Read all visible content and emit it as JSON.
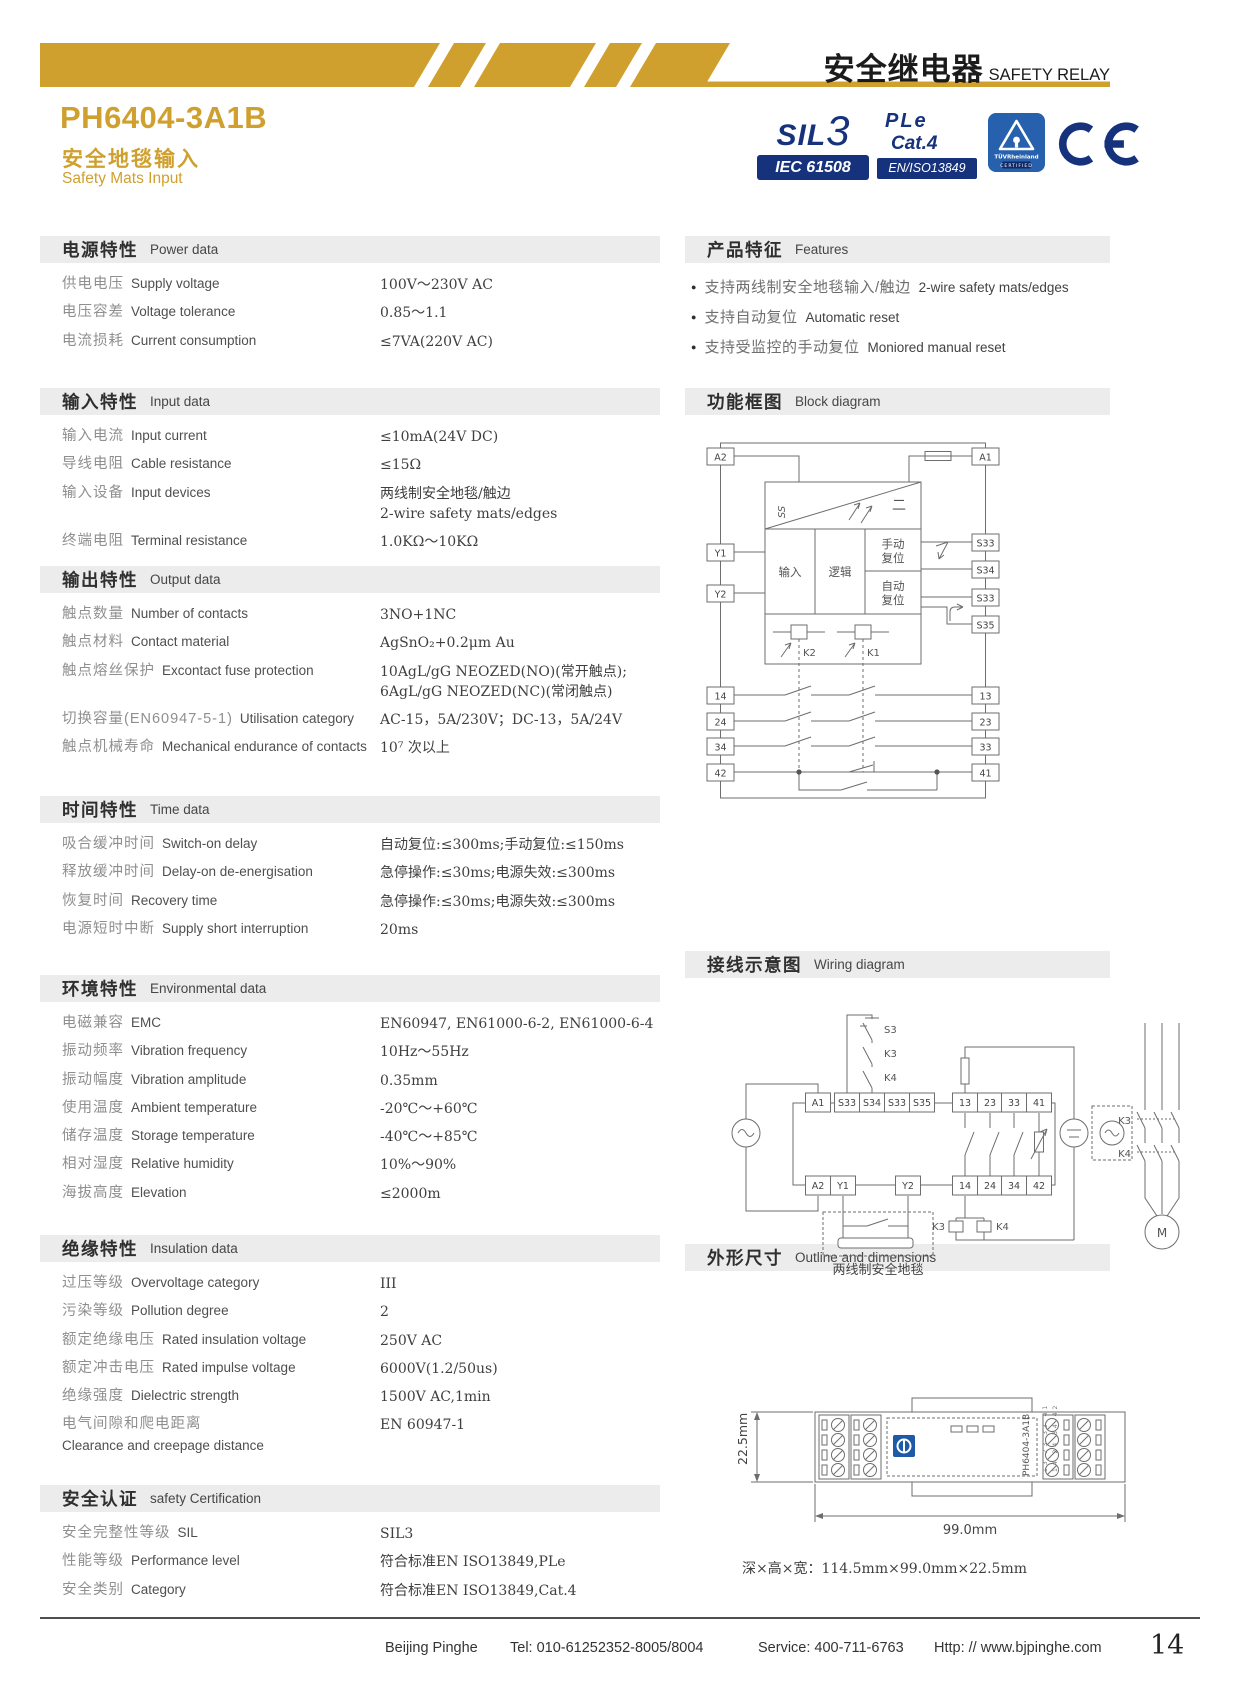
{
  "colors": {
    "accent_gold": "#D0A02E",
    "badge_navy": "#16327C",
    "tuv_blue": "#2760AC"
  },
  "header": {
    "brand_cn": "安全继电器",
    "brand_en": "SAFETY RELAY",
    "model": "PH6404-3A1B",
    "subtitle_cn": "安全地毯输入",
    "subtitle_en": "Safety Mats Input"
  },
  "badges": {
    "sil_text": "SIL",
    "sil_level": "3",
    "sil_standard": "IEC 61508",
    "pl_line1": "PLe",
    "pl_line2": "Cat.4",
    "pl_standard": "EN/ISO13849",
    "tuv_name": "TÜVRheinland",
    "tuv_sub": "CERTIFIED",
    "ce_mark": "CE"
  },
  "spec_sections": [
    {
      "id": "power",
      "title_cn": "电源特性",
      "title_en": "Power data",
      "rows": [
        {
          "cn": "供电电压",
          "en": "Supply voltage",
          "value": [
            "100V～230V AC"
          ]
        },
        {
          "cn": "电压容差",
          "en": "Voltage tolerance",
          "value": [
            "0.85～1.1"
          ]
        },
        {
          "cn": "电流损耗",
          "en": "Current consumption",
          "value": [
            "≤7VA(220V AC)"
          ]
        }
      ]
    },
    {
      "id": "input",
      "title_cn": "输入特性",
      "title_en": "Input data",
      "rows": [
        {
          "cn": "输入电流",
          "en": "Input current",
          "value": [
            "≤10mA(24V DC)"
          ]
        },
        {
          "cn": "导线电阻",
          "en": "Cable resistance",
          "value": [
            "≤15Ω"
          ]
        },
        {
          "cn": "输入设备",
          "en": "Input devices",
          "value": [
            "两线制安全地毯/触边",
            "2-wire safety mats/edges"
          ]
        },
        {
          "cn": "终端电阻",
          "en": "Terminal resistance",
          "value": [
            "1.0KΩ～10KΩ"
          ]
        }
      ]
    },
    {
      "id": "output",
      "title_cn": "输出特性",
      "title_en": "Output data",
      "rows": [
        {
          "cn": "触点数量",
          "en": "Number of contacts",
          "value": [
            "3NO+1NC"
          ]
        },
        {
          "cn": "触点材料",
          "en": "Contact material",
          "value": [
            "AgSnO₂+0.2μm Au"
          ]
        },
        {
          "cn": "触点熔丝保护",
          "en": "Excontact fuse protection",
          "value": [
            "10AgL/gG NEOZED(NO)(常开触点);",
            "6AgL/gG NEOZED(NC)(常闭触点)"
          ]
        },
        {
          "cn": "切换容量(EN60947-5-1)",
          "en": "Utilisation category",
          "value": [
            "AC-15，5A/230V；DC-13，5A/24V"
          ]
        },
        {
          "cn": "触点机械寿命",
          "en": "Mechanical endurance of contacts",
          "value": [
            "10⁷ 次以上"
          ]
        }
      ]
    },
    {
      "id": "time",
      "title_cn": "时间特性",
      "title_en": "Time data",
      "rows": [
        {
          "cn": "吸合缓冲时间",
          "en": "Switch-on delay",
          "value": [
            "自动复位:≤300ms;手动复位:≤150ms"
          ]
        },
        {
          "cn": "释放缓冲时间",
          "en": "Delay-on de-energisation",
          "value": [
            "急停操作:≤30ms;电源失效:≤300ms"
          ]
        },
        {
          "cn": "恢复时间",
          "en": "Recovery time",
          "value": [
            "急停操作:≤30ms;电源失效:≤300ms"
          ]
        },
        {
          "cn": "电源短时中断",
          "en": "Supply short interruption",
          "value": [
            "20ms"
          ]
        }
      ]
    },
    {
      "id": "environment",
      "title_cn": "环境特性",
      "title_en": "Environmental data",
      "rows": [
        {
          "cn": "电磁兼容",
          "en": "EMC",
          "value": [
            "EN60947, EN61000-6-2, EN61000-6-4"
          ]
        },
        {
          "cn": "振动频率",
          "en": "Vibration frequency",
          "value": [
            "10Hz～55Hz"
          ]
        },
        {
          "cn": "振动幅度",
          "en": "Vibration amplitude",
          "value": [
            "0.35mm"
          ]
        },
        {
          "cn": "使用温度",
          "en": "Ambient temperature",
          "value": [
            "-20℃～+60℃"
          ]
        },
        {
          "cn": "储存温度",
          "en": "Storage temperature",
          "value": [
            "-40℃～+85℃"
          ]
        },
        {
          "cn": "相对湿度",
          "en": "Relative humidity",
          "value": [
            "10%～90%"
          ]
        },
        {
          "cn": "海拔高度",
          "en": "Elevation",
          "value": [
            "≤2000m"
          ]
        }
      ]
    },
    {
      "id": "insulation",
      "title_cn": "绝缘特性",
      "title_en": "Insulation data",
      "rows": [
        {
          "cn": "过压等级",
          "en": "Overvoltage category",
          "value": [
            "III"
          ]
        },
        {
          "cn": "污染等级",
          "en": "Pollution degree",
          "value": [
            "2"
          ]
        },
        {
          "cn": "额定绝缘电压",
          "en": "Rated insulation voltage",
          "value": [
            "250V AC"
          ]
        },
        {
          "cn": "额定冲击电压",
          "en": "Rated impulse voltage",
          "value": [
            "6000V(1.2/50us)"
          ]
        },
        {
          "cn": "绝缘强度",
          "en": "Dielectric strength",
          "value": [
            "1500V AC,1min"
          ]
        },
        {
          "cn": "电气间隙和爬电距离",
          "en": "Clearance and creepage distance",
          "en_below": true,
          "value": [
            "EN 60947-1"
          ]
        }
      ]
    },
    {
      "id": "certification",
      "title_cn": "安全认证",
      "title_en": "safety Certification",
      "rows": [
        {
          "cn": "安全完整性等级",
          "en": "SIL",
          "value": [
            "SIL3"
          ]
        },
        {
          "cn": "性能等级",
          "en": "Performance level",
          "value": [
            "符合标准EN ISO13849,PLe"
          ]
        },
        {
          "cn": "安全类别",
          "en": "Category",
          "value": [
            "符合标准EN ISO13849,Cat.4"
          ]
        }
      ]
    }
  ],
  "features": {
    "title_cn": "产品特征",
    "title_en": "Features",
    "items": [
      {
        "cn": "支持两线制安全地毯输入/触边",
        "en": "2-wire safety mats/edges"
      },
      {
        "cn": "支持自动复位",
        "en": "Automatic reset"
      },
      {
        "cn": "支持受监控的手动复位",
        "en": "Moniored manual reset"
      }
    ]
  },
  "block_diagram": {
    "title_cn": "功能框图",
    "title_en": "Block diagram",
    "labels": {
      "a2": "A2",
      "a1": "A1",
      "y1": "Y1",
      "y2": "Y2",
      "s33a": "S33",
      "s34": "S34",
      "s33b": "S33",
      "s35": "S35",
      "input": "输入",
      "logic": "逻辑",
      "manual_1": "手动",
      "manual_2": "复位",
      "auto_1": "自动",
      "auto_2": "复位",
      "k2": "K2",
      "k1": "K1",
      "t14": "14",
      "t24": "24",
      "t34": "34",
      "t42": "42",
      "t13": "13",
      "t23": "23",
      "t33": "33",
      "t41": "41",
      "ss": "SS",
      "dc": "二"
    }
  },
  "wiring_diagram": {
    "title_cn": "接线示意图",
    "title_en": "Wiring diagram",
    "labels": {
      "s3": "S3",
      "k3_top": "K3",
      "k4_top": "K4",
      "top_terminals": [
        "A1",
        "S33",
        "S34",
        "S33",
        "S35",
        "13",
        "23",
        "33",
        "41"
      ],
      "bottom_terminals": [
        "A2",
        "Y1",
        "Y2",
        "14",
        "24",
        "34",
        "42"
      ],
      "k3_right": "K3",
      "k4_right": "K4",
      "motor": "M",
      "k3_coil": "K3",
      "k4_coil": "K4",
      "mat_label": "两线制安全地毯"
    }
  },
  "outline": {
    "title_cn": "外形尺寸",
    "title_en": "Outline and dimensions",
    "height_label": "22.5mm",
    "width_label": "99.0mm",
    "device_label": "PH6404-3A1B",
    "mini_terminals_1": "13 23 33 41",
    "mini_terminals_2": "14 24 34 42",
    "dimension_note": "深×高×宽：114.5mm×99.0mm×22.5mm"
  },
  "footer": {
    "company": "Beijing Pinghe",
    "tel": "Tel: 010-61252352-8005/8004",
    "service": "Service: 400-711-6763",
    "website": "Http: // www.bjpinghe.com",
    "page_number": "14"
  }
}
